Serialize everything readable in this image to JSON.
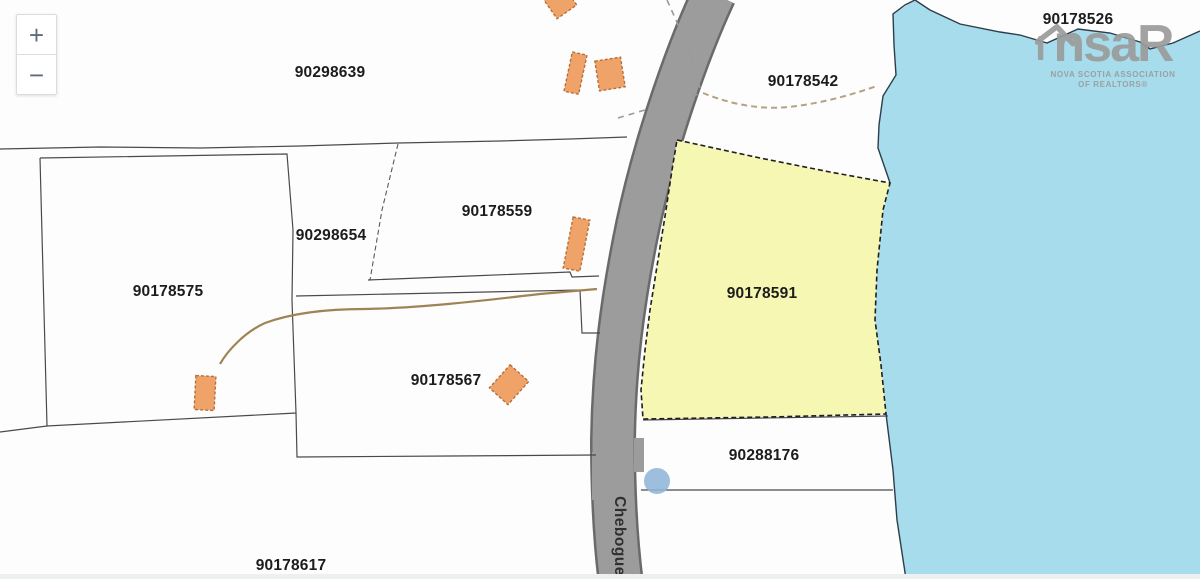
{
  "controls": {
    "zoom_in": "+",
    "zoom_out": "−"
  },
  "parcels": [
    {
      "id": "90298639"
    },
    {
      "id": "90178542"
    },
    {
      "id": "90178526"
    },
    {
      "id": "90178559"
    },
    {
      "id": "90298654"
    },
    {
      "id": "90178575"
    },
    {
      "id": "90178567"
    },
    {
      "id": "90178591",
      "highlighted": true
    },
    {
      "id": "90288176"
    },
    {
      "id": "90178617"
    }
  ],
  "road": {
    "name": "Chebogue"
  },
  "logo": {
    "prefix": "ns",
    "suffix": "aR",
    "line1": "NOVA SCOTIA ASSOCIATION",
    "line2": "OF REALTORS®"
  },
  "colors": {
    "water": "#a6dcec",
    "highlight_parcel": "#f7f7b4",
    "road": "#9c9c9c",
    "road_edge": "#6a6a6a",
    "building": "#f0a368",
    "boundary": "#4a4a4a",
    "highlight_label": "#72715a",
    "poi_dot": "#8fb5d8",
    "logo_gray": "#9b9b9b"
  }
}
